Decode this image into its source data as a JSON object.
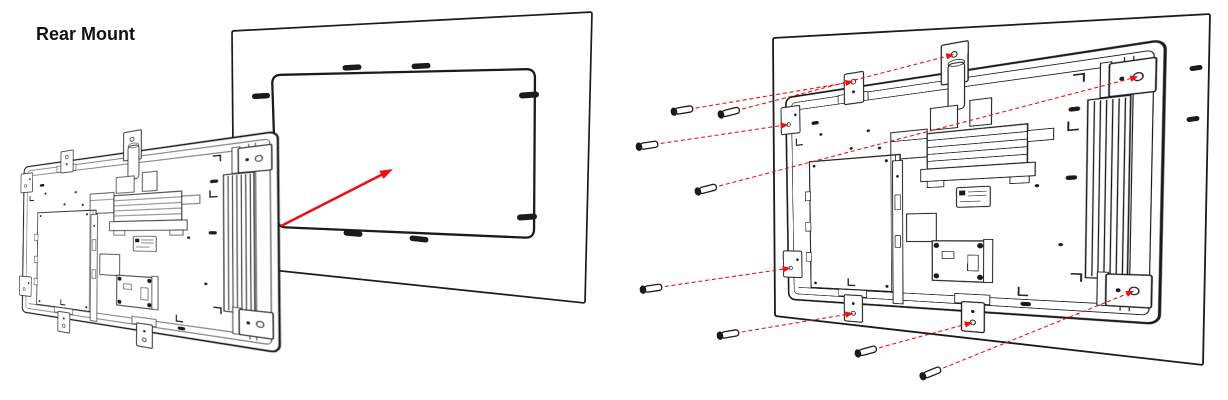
{
  "title": "Rear Mount",
  "colors": {
    "ink": "#1b1b1b",
    "red": "#ee1111",
    "paper": "#ffffff"
  },
  "device": {
    "local_width": 430,
    "local_height": 300
  },
  "figure_before": {
    "label": "align-device-to-wall-cutout",
    "wall_quad": [
      [
        232,
        31
      ],
      [
        592,
        12
      ],
      [
        585,
        303
      ],
      [
        234,
        266
      ]
    ],
    "cutout_quad": [
      [
        272,
        75
      ],
      [
        535,
        69
      ],
      [
        534,
        238
      ],
      [
        277,
        227
      ]
    ],
    "cutout_radius": 9,
    "slots": [
      {
        "cx": 352,
        "cy": 67.5,
        "len": 19,
        "wid": 5.5,
        "angle": -3
      },
      {
        "cx": 421,
        "cy": 66,
        "len": 19,
        "wid": 5.5,
        "angle": -3
      },
      {
        "cx": 353,
        "cy": 233.5,
        "len": 19,
        "wid": 5.5,
        "angle": 5
      },
      {
        "cx": 419,
        "cy": 239,
        "len": 19,
        "wid": 5.5,
        "angle": 6
      },
      {
        "cx": 261,
        "cy": 96,
        "len": 18,
        "wid": 5.5,
        "angle": -3
      },
      {
        "cx": 529,
        "cy": 95,
        "len": 20,
        "wid": 6,
        "angle": -4
      },
      {
        "cx": 527,
        "cy": 217,
        "len": 20,
        "wid": 6,
        "angle": -4
      }
    ],
    "device_quad": [
      [
        25,
        168
      ],
      [
        276,
        133
      ],
      [
        278,
        351
      ],
      [
        23,
        311
      ]
    ],
    "arrow": {
      "from": [
        281,
        226
      ],
      "to": [
        393,
        169
      ]
    }
  },
  "figure_after": {
    "label": "fasten-device-with-screws",
    "wall_quad": [
      [
        773,
        38
      ],
      [
        1210,
        14
      ],
      [
        1203,
        365
      ],
      [
        775,
        316
      ]
    ],
    "wall_slots": [
      {
        "cx": 1196,
        "cy": 68,
        "len": 13,
        "wid": 5,
        "angle": -8
      },
      {
        "cx": 1193,
        "cy": 119,
        "len": 13,
        "wid": 5,
        "angle": -8
      }
    ],
    "device_quad": [
      [
        787,
        99
      ],
      [
        1163,
        42
      ],
      [
        1157,
        322
      ],
      [
        790,
        298
      ]
    ],
    "screw_count": 8,
    "screws": [
      {
        "x": 672,
        "y": 112,
        "target": "A"
      },
      {
        "x": 719,
        "y": 115,
        "target": "C"
      },
      {
        "x": 637,
        "y": 147,
        "target": "B"
      },
      {
        "x": 696,
        "y": 192,
        "target": "D"
      },
      {
        "x": 641,
        "y": 290,
        "target": "E"
      },
      {
        "x": 718,
        "y": 336,
        "target": "F"
      },
      {
        "x": 856,
        "y": 354,
        "target": "G"
      },
      {
        "x": 921,
        "y": 377,
        "target": "H"
      }
    ],
    "screw_targets_local": {
      "A": [
        100,
        -10
      ],
      "B": [
        2,
        38
      ],
      "C": [
        228,
        -24
      ],
      "D": [
        410,
        33
      ],
      "E": [
        2,
        254
      ],
      "F": [
        97,
        316
      ],
      "G": [
        250,
        316
      ],
      "H": [
        410,
        267
      ]
    }
  }
}
